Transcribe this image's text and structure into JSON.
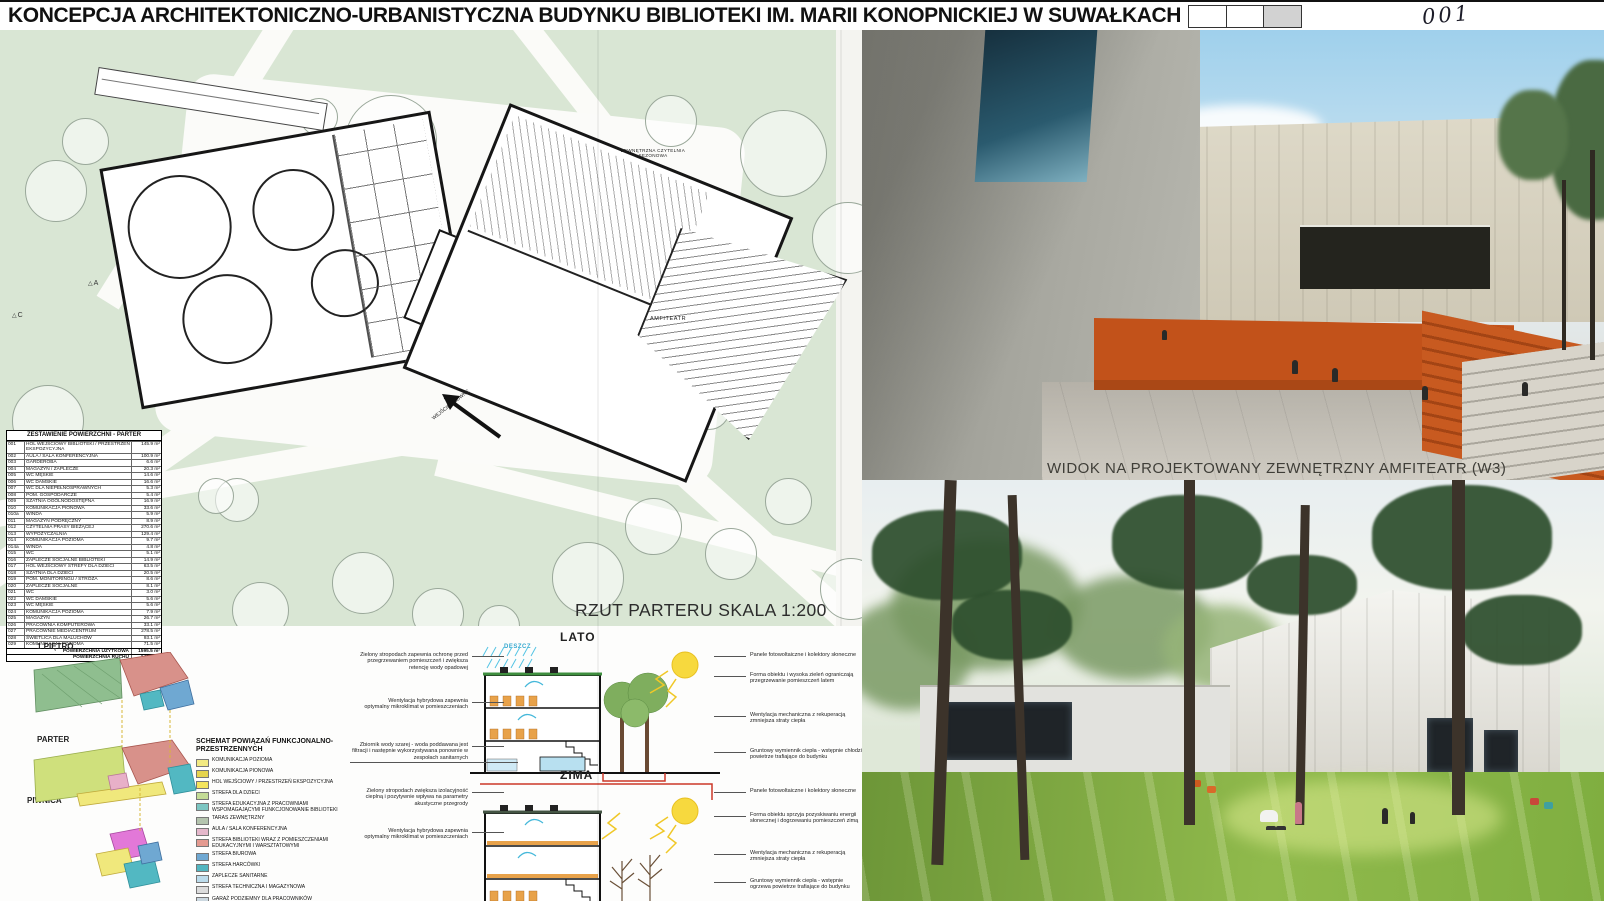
{
  "header": {
    "title": "KONCEPCJA ARCHITEKTONICZNO-URBANISTYCZNA BUDYNKU BIBLIOTEKI IM. MARII KONOPNICKIEJ W SUWAŁKACH",
    "sheet_number": "001"
  },
  "site_plan": {
    "caption": "RZUT PARTERU SKALA 1:200",
    "labels": {
      "outdoor_reading": "ZEWNĘTRZNA CZYTELNIA SEZONOWA",
      "amphitheater": "AMFITEATR",
      "entrance": "WEJŚCIE GŁÓWNE",
      "section_a": "A",
      "section_c": "C"
    }
  },
  "area_table": {
    "title": "ZESTAWIENIE POWIERZCHNI - PARTER",
    "rows": [
      {
        "id": "001",
        "name": "HOL WEJŚCIOWY BIBLIOTEKI / PRZESTRZEŃ EKSPOZYCYJNA",
        "area": "145.9 m²"
      },
      {
        "id": "002",
        "name": "AULA / SALA KONFERENCYJNA",
        "area": "100.9 m²"
      },
      {
        "id": "003",
        "name": "GARDEROBA",
        "area": "6.6 m²"
      },
      {
        "id": "004",
        "name": "MAGAZYN / ZAPLECZE",
        "area": "20.3 m²"
      },
      {
        "id": "005",
        "name": "WC MĘSKIE",
        "area": "14.6 m²"
      },
      {
        "id": "006",
        "name": "WC DAMSKIE",
        "area": "16.6 m²"
      },
      {
        "id": "007",
        "name": "WC DLA NIEPEŁNOSPRAWNYCH",
        "area": "5.3 m²"
      },
      {
        "id": "008",
        "name": "POM. GOSPODARCZE",
        "area": "5.4 m²"
      },
      {
        "id": "009",
        "name": "SZATNIA OGÓLNODOSTĘPNA",
        "area": "16.9 m²"
      },
      {
        "id": "010",
        "name": "KOMUNIKACJA PIONOWA",
        "area": "33.6 m²"
      },
      {
        "id": "010a",
        "name": "WINDA",
        "area": "5.9 m²"
      },
      {
        "id": "011",
        "name": "MAGAZYN PODRĘCZNY",
        "area": "8.9 m²"
      },
      {
        "id": "012",
        "name": "CZYTELNIA PRASY BIEŻĄCEJ",
        "area": "270.6 m²"
      },
      {
        "id": "013",
        "name": "WYPOŻYCZALNIA",
        "area": "129.4 m²"
      },
      {
        "id": "014",
        "name": "KOMUNIKACJA POZIOMA",
        "area": "9.7 m²"
      },
      {
        "id": "014a",
        "name": "WINDA",
        "area": "4.8 m²"
      },
      {
        "id": "015",
        "name": "WC",
        "area": "5.1 m²"
      },
      {
        "id": "016",
        "name": "ZAPLECZE SOCJALNE BIBLIOTEKI",
        "area": "14.9 m²"
      },
      {
        "id": "017",
        "name": "HOL WEJŚCIOWY STREFY DLA DZIECI",
        "area": "63.5 m²"
      },
      {
        "id": "018",
        "name": "SZATNIA DLA DZIECI",
        "area": "20.5 m²"
      },
      {
        "id": "019",
        "name": "POM. MONITORINGU / STRÓŻA",
        "area": "8.6 m²"
      },
      {
        "id": "020",
        "name": "ZAPLECZE SOCJALNE",
        "area": "8.1 m²"
      },
      {
        "id": "021",
        "name": "WC",
        "area": "3.0 m²"
      },
      {
        "id": "022",
        "name": "WC DAMSKIE",
        "area": "5.6 m²"
      },
      {
        "id": "023",
        "name": "WC MĘSKIE",
        "area": "5.6 m²"
      },
      {
        "id": "024",
        "name": "KOMUNIKACJA POZIOMA",
        "area": "7.9 m²"
      },
      {
        "id": "025",
        "name": "MAGAZYN",
        "area": "26.7 m²"
      },
      {
        "id": "026",
        "name": "PRACOWNIA KOMPUTEROWA",
        "area": "33.1 m²"
      },
      {
        "id": "027",
        "name": "PRACOWNIE MEDIACENTRUM",
        "area": "278.5 m²"
      },
      {
        "id": "028",
        "name": "ŚWIETLICA DLA MALUCHÓW",
        "area": "93.1 m²"
      },
      {
        "id": "029",
        "name": "KOMUNIKACJA POZIOMA",
        "area": "71.5 m²"
      }
    ],
    "summary": [
      {
        "name": "POWIERZCHNIA UŻYTKOWA",
        "area": "1595.5 m²"
      },
      {
        "name": "POWIERZCHNIA RUCHU",
        "area": "145.9 m²"
      }
    ]
  },
  "scheme": {
    "floors": [
      "1 PIĘTRO",
      "PARTER",
      "PIWNICA"
    ],
    "legend_title": "SCHEMAT POWIĄZAŃ FUNKCJONALNO-PRZESTRZENNYCH",
    "legend": [
      {
        "label": "KOMUNIKACJA POZIOMA",
        "color": "#f2ea82"
      },
      {
        "label": "KOMUNIKACJA PIONOWA",
        "color": "#e6d44e"
      },
      {
        "label": "HOL WEJŚCIOWY / PRZESTRZEŃ EKSPOZYCYJNA",
        "color": "#f4e45c"
      },
      {
        "label": "STREFA DLA DZIECI",
        "color": "#c4dc96"
      },
      {
        "label": "STREFA EDUKACYJNA Z PRACOWNIAMI WSPOMAGAJĄCYMI FUNKCJONOWANIE BIBLIOTEKI",
        "color": "#7cc6c2"
      },
      {
        "label": "TARAS ZEWNĘTRZNY",
        "color": "#b4c4ae"
      },
      {
        "label": "AULA / SALA KONFERENCYJNA",
        "color": "#e5b8cb"
      },
      {
        "label": "STREFA BIBLIOTEKI WRAZ Z POMIESZCZENIAMI EDUKACYJNYMI I WARSZTATOWYMI",
        "color": "#e49a90"
      },
      {
        "label": "STREFA BIUROWA",
        "color": "#6fa8d2"
      },
      {
        "label": "STREFA HARCÓWKI",
        "color": "#52b6c0"
      },
      {
        "label": "ZAPLECZE SANITARNE",
        "color": "#bcdcec"
      },
      {
        "label": "STREFA TECHNICZNA I MAGAZYNOWA",
        "color": "#dcdcdc"
      },
      {
        "label": "GARAŻ PODZIEMNY DLA PRACOWNIKÓW",
        "color": "#ccd8e0"
      }
    ]
  },
  "sections": {
    "summer": {
      "title": "LATO",
      "rain_label": "DESZCZ",
      "left_notes": [
        {
          "text": "Zielony stropodach zapewnia ochronę przed przegrzewaniem pomieszczeń i zwiększa retencję wody opadowej"
        },
        {
          "text": "Wentylacja hybrydowa zapewnia optymalny mikroklimat w pomieszczeniach"
        },
        {
          "text": "Zbiornik wody szarej - woda poddawana jest filtracji i następnie wykorzystywana ponownie w zespołach sanitarnych"
        }
      ],
      "right_notes": [
        {
          "text": "Panele fotowoltaiczne i kolektory słoneczne"
        },
        {
          "text": "Forma obiektu i wysoka zieleń ograniczają przegrzewanie pomieszczeń latem"
        },
        {
          "text": "Wentylacja mechaniczna z rekuperacją zmniejsza straty ciepła"
        },
        {
          "text": "Gruntowy wymiennik ciepła - wstępnie chłodzi powietrze trafiające do budynku"
        }
      ]
    },
    "winter": {
      "title": "ZIMA",
      "left_notes": [
        {
          "text": "Zielony stropodach zwiększa izolacyjność cieplną i pozytywnie wpływa na parametry akustyczne przegrody"
        },
        {
          "text": "Wentylacja hybrydowa zapewnia optymalny mikroklimat w pomieszczeniach"
        }
      ],
      "right_notes": [
        {
          "text": "Panele fotowoltaiczne i kolektory słoneczne"
        },
        {
          "text": "Forma obiektu sprzyja pozyskiwaniu energii słonecznej i dogrzewaniu pomieszczeń zimą"
        },
        {
          "text": "Wentylacja mechaniczna z rekuperacją zmniejsza straty ciepła"
        },
        {
          "text": "Gruntowy wymiennik ciepła - wstępnie ogrzewa powietrze trafiające do budynku"
        }
      ]
    }
  },
  "renders": {
    "amphitheater_caption": "WIDOK NA PROJEKTOWANY ZEWNĘTRZNY AMFITEATR (W3)"
  }
}
